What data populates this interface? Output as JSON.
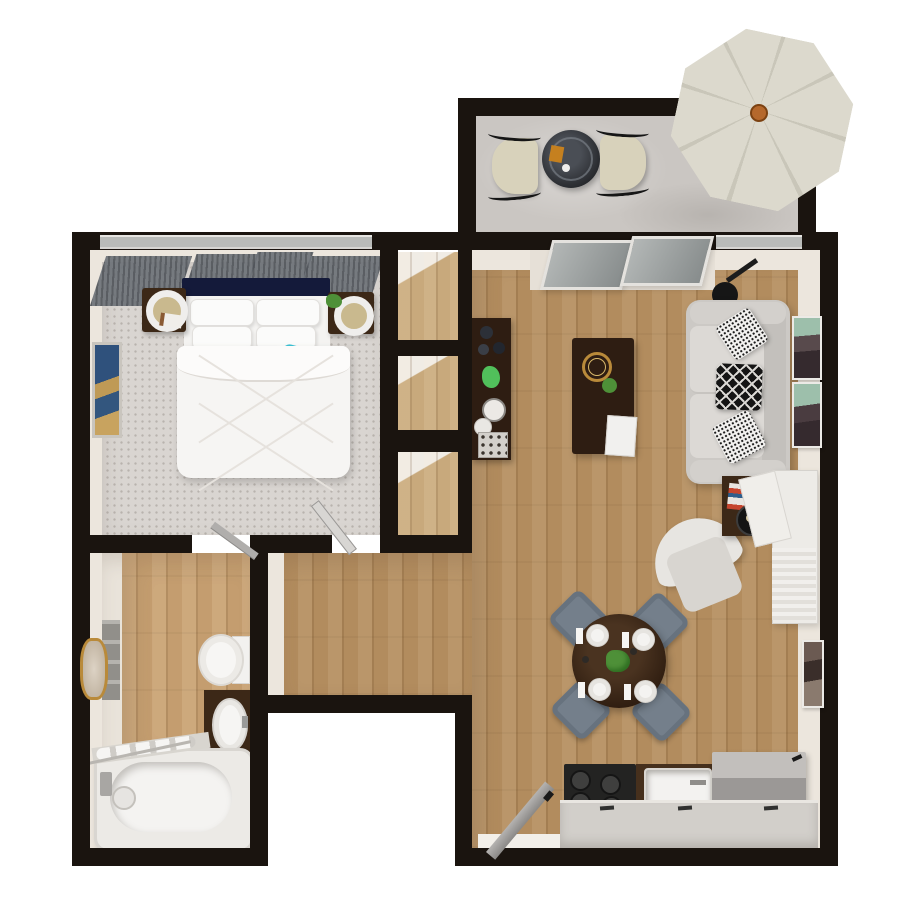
{
  "meta": {
    "title": "3D top-down floor plan of a one-bedroom apartment with patio",
    "view": "bird's-eye 3D render",
    "canvas": {
      "width": 900,
      "height": 900
    }
  },
  "colors": {
    "wall": "#1a140f",
    "wallFace": "#ece6dd",
    "wood": "#b28c5e",
    "woodLight": "#c8a97c",
    "darkWood": "#2e1d12",
    "darkWood2": "#3c2817",
    "carpet": "#d9d5d1",
    "concrete": "#cac6c2",
    "navy": "#141a3a",
    "blue": "#1d36c0",
    "teal": "#3cc3d6",
    "sofa": "#ccc9c5",
    "sofaSeat": "#dcd9d5",
    "slate": "#747f8b",
    "stove": "#232322",
    "fridge": "#9b9896",
    "counter": "#d2cfca",
    "cream": "#d8d2bb",
    "umbrella": "#dcd9cd",
    "umbrellaRib": "#c9c6b9",
    "green": "#4e9038",
    "gold": "#b98a3a",
    "artTeal": "#9dbfab",
    "artDark": "#352a2e",
    "tub": "#f4f3f1"
  },
  "rooms": [
    {
      "name": "patio",
      "floor": "concrete",
      "position": "top-right"
    },
    {
      "name": "bedroom",
      "floor": "carpet",
      "position": "top-left"
    },
    {
      "name": "closets",
      "floor": "hardwood",
      "count": 3,
      "position": "center-left column"
    },
    {
      "name": "hallway",
      "floor": "hardwood",
      "position": "center"
    },
    {
      "name": "bathroom",
      "floor": "hardwood-and-tile",
      "position": "bottom-left"
    },
    {
      "name": "living-room",
      "floor": "hardwood",
      "position": "right"
    },
    {
      "name": "dining-area",
      "floor": "hardwood",
      "position": "center-right"
    },
    {
      "name": "kitchen",
      "floor": "hardwood",
      "position": "bottom-right"
    }
  ],
  "furniture": {
    "patio": [
      "octagonal-market-umbrella-cream",
      "round-glass-bistro-table",
      "patio-chair-left",
      "patio-chair-right",
      "amber-card-on-table"
    ],
    "bedroom": [
      "queen-bed-white-duvet",
      "navy-headboard",
      "white-pillows-x4",
      "teal-accent-pillows-x2",
      "navy-accent-pillow",
      "nightstand-left-with-lamp-and-book",
      "nightstand-right-with-lamp-and-plant",
      "gray-curtain-panels-x4",
      "abstract-wall-art-blue-gold",
      "hinged-door"
    ],
    "closets": [
      "wood-floor-niche-x3"
    ],
    "bathroom": [
      "bathtub-with-faucet-and-drain",
      "towel-shelf-with-rolls",
      "toilet",
      "dark-wood-vanity-with-oval-sink",
      "gold-framed-mirror",
      "gray-towel-stack",
      "hinged-door"
    ],
    "living-room": [
      "three-seat-sofa-light-gray",
      "black-white-speckled-pillows-x2",
      "black-diamond-pattern-pillow",
      "electric-guitar-black",
      "dark-wood-coffee-table",
      "gold-wire-basket",
      "green-bowl",
      "white-magazine",
      "dark-wood-console-with-vases-plant-clock-plates-tray",
      "white-swivel-armchair",
      "dark-wood-side-table-with-books-and-round-tray",
      "white-desk-console-with-tambour-front",
      "teal-black-wall-art-x2",
      "dark-wall-art-x1",
      "sliding-glass-door-2-panels"
    ],
    "dining-area": [
      "round-dark-wood-table",
      "slate-upholstered-chairs-x4",
      "place-settings-x4-plates-napkins",
      "green-centerpiece-plant"
    ],
    "kitchen": [
      "black-range-4-burners",
      "dark-counter-with-white-sink",
      "refrigerator-gray",
      "lower-counter-run-with-handles",
      "entry-door-open"
    ]
  }
}
